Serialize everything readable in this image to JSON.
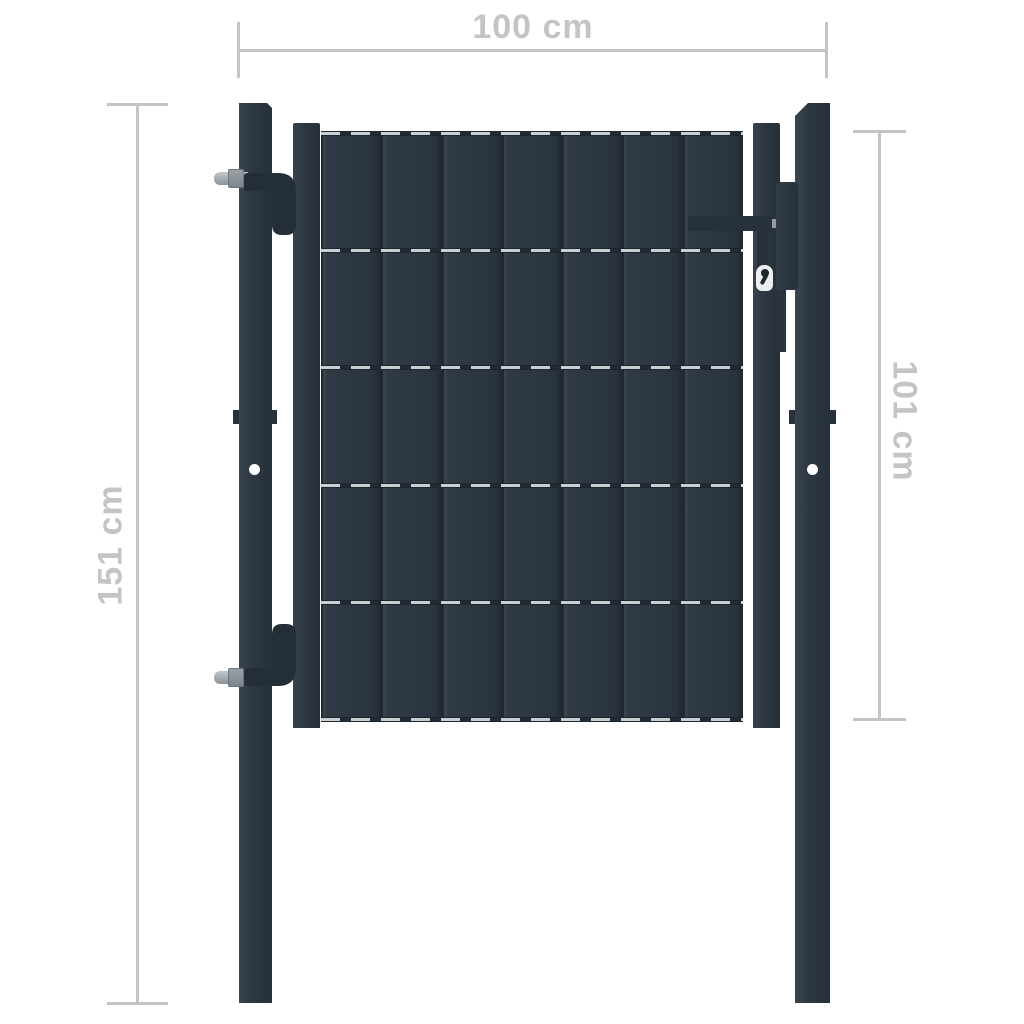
{
  "page": {
    "background": "#ffffff"
  },
  "dimensions": {
    "top_width": "100 cm",
    "left_height": "151 cm",
    "right_height": "101 cm"
  },
  "colors": {
    "page_bg": "#ffffff",
    "annotation": "#c3c4c6",
    "gate_body": "#2e3842",
    "gate_edge": "#212a33",
    "gate_highlight": "#3a444e",
    "metal": "#9aa1a7",
    "rail_wire": "#c9ced2",
    "hole_white": "#ffffff"
  },
  "structure": {
    "slat_count": 7,
    "rail_count": 6
  }
}
